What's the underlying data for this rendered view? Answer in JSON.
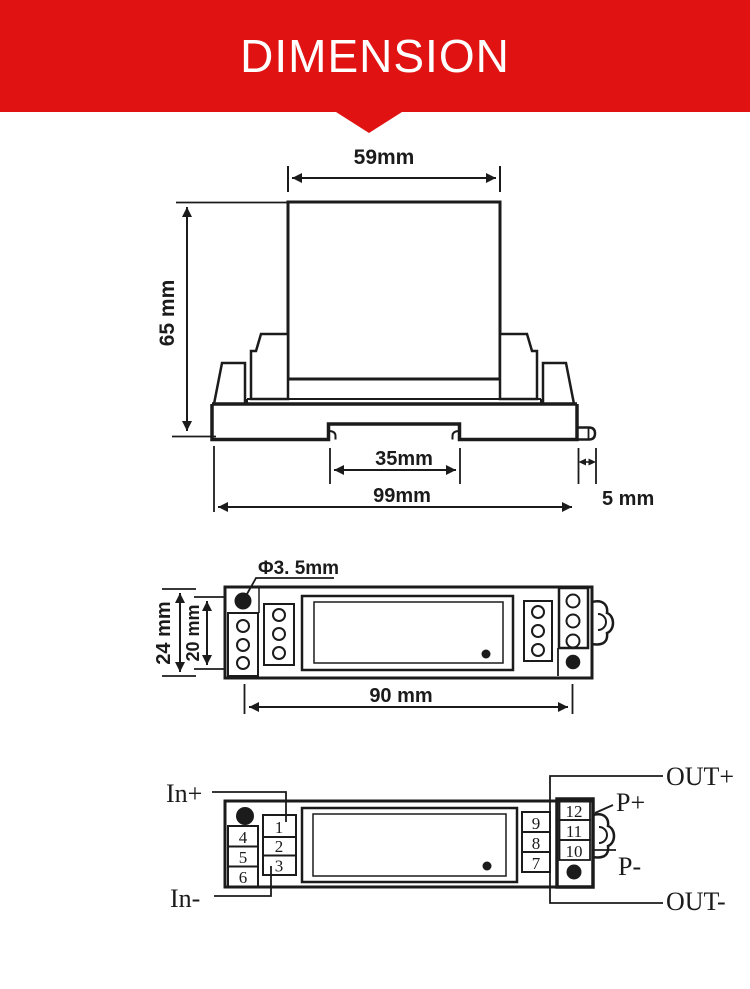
{
  "header": {
    "title": "DIMENSION",
    "accent_color": "#e01212",
    "text_color": "#ffffff"
  },
  "line_color": "#1b1b1b",
  "front_view": {
    "dim_top_width": "59mm",
    "dim_height": "65 mm",
    "dim_rail_notch": "35mm",
    "dim_total_width": "99mm",
    "dim_side_tab": "5 mm"
  },
  "top_view": {
    "dim_hole_diameter": "Φ3. 5mm",
    "dim_outer_height": "24 mm",
    "dim_inner_height": "20 mm",
    "dim_hole_spacing": "90 mm"
  },
  "wiring_view": {
    "labels": {
      "in_plus": "In+",
      "in_minus": "In-",
      "out_plus": "OUT+",
      "out_minus": "OUT-",
      "p_plus": "P+",
      "p_minus": "P-"
    },
    "left_outer_terminals": [
      "4",
      "5",
      "6"
    ],
    "left_inner_terminals": [
      "1",
      "2",
      "3"
    ],
    "right_inner_terminals": [
      "9",
      "8",
      "7"
    ],
    "right_outer_terminals": [
      "12",
      "11",
      "10"
    ]
  }
}
